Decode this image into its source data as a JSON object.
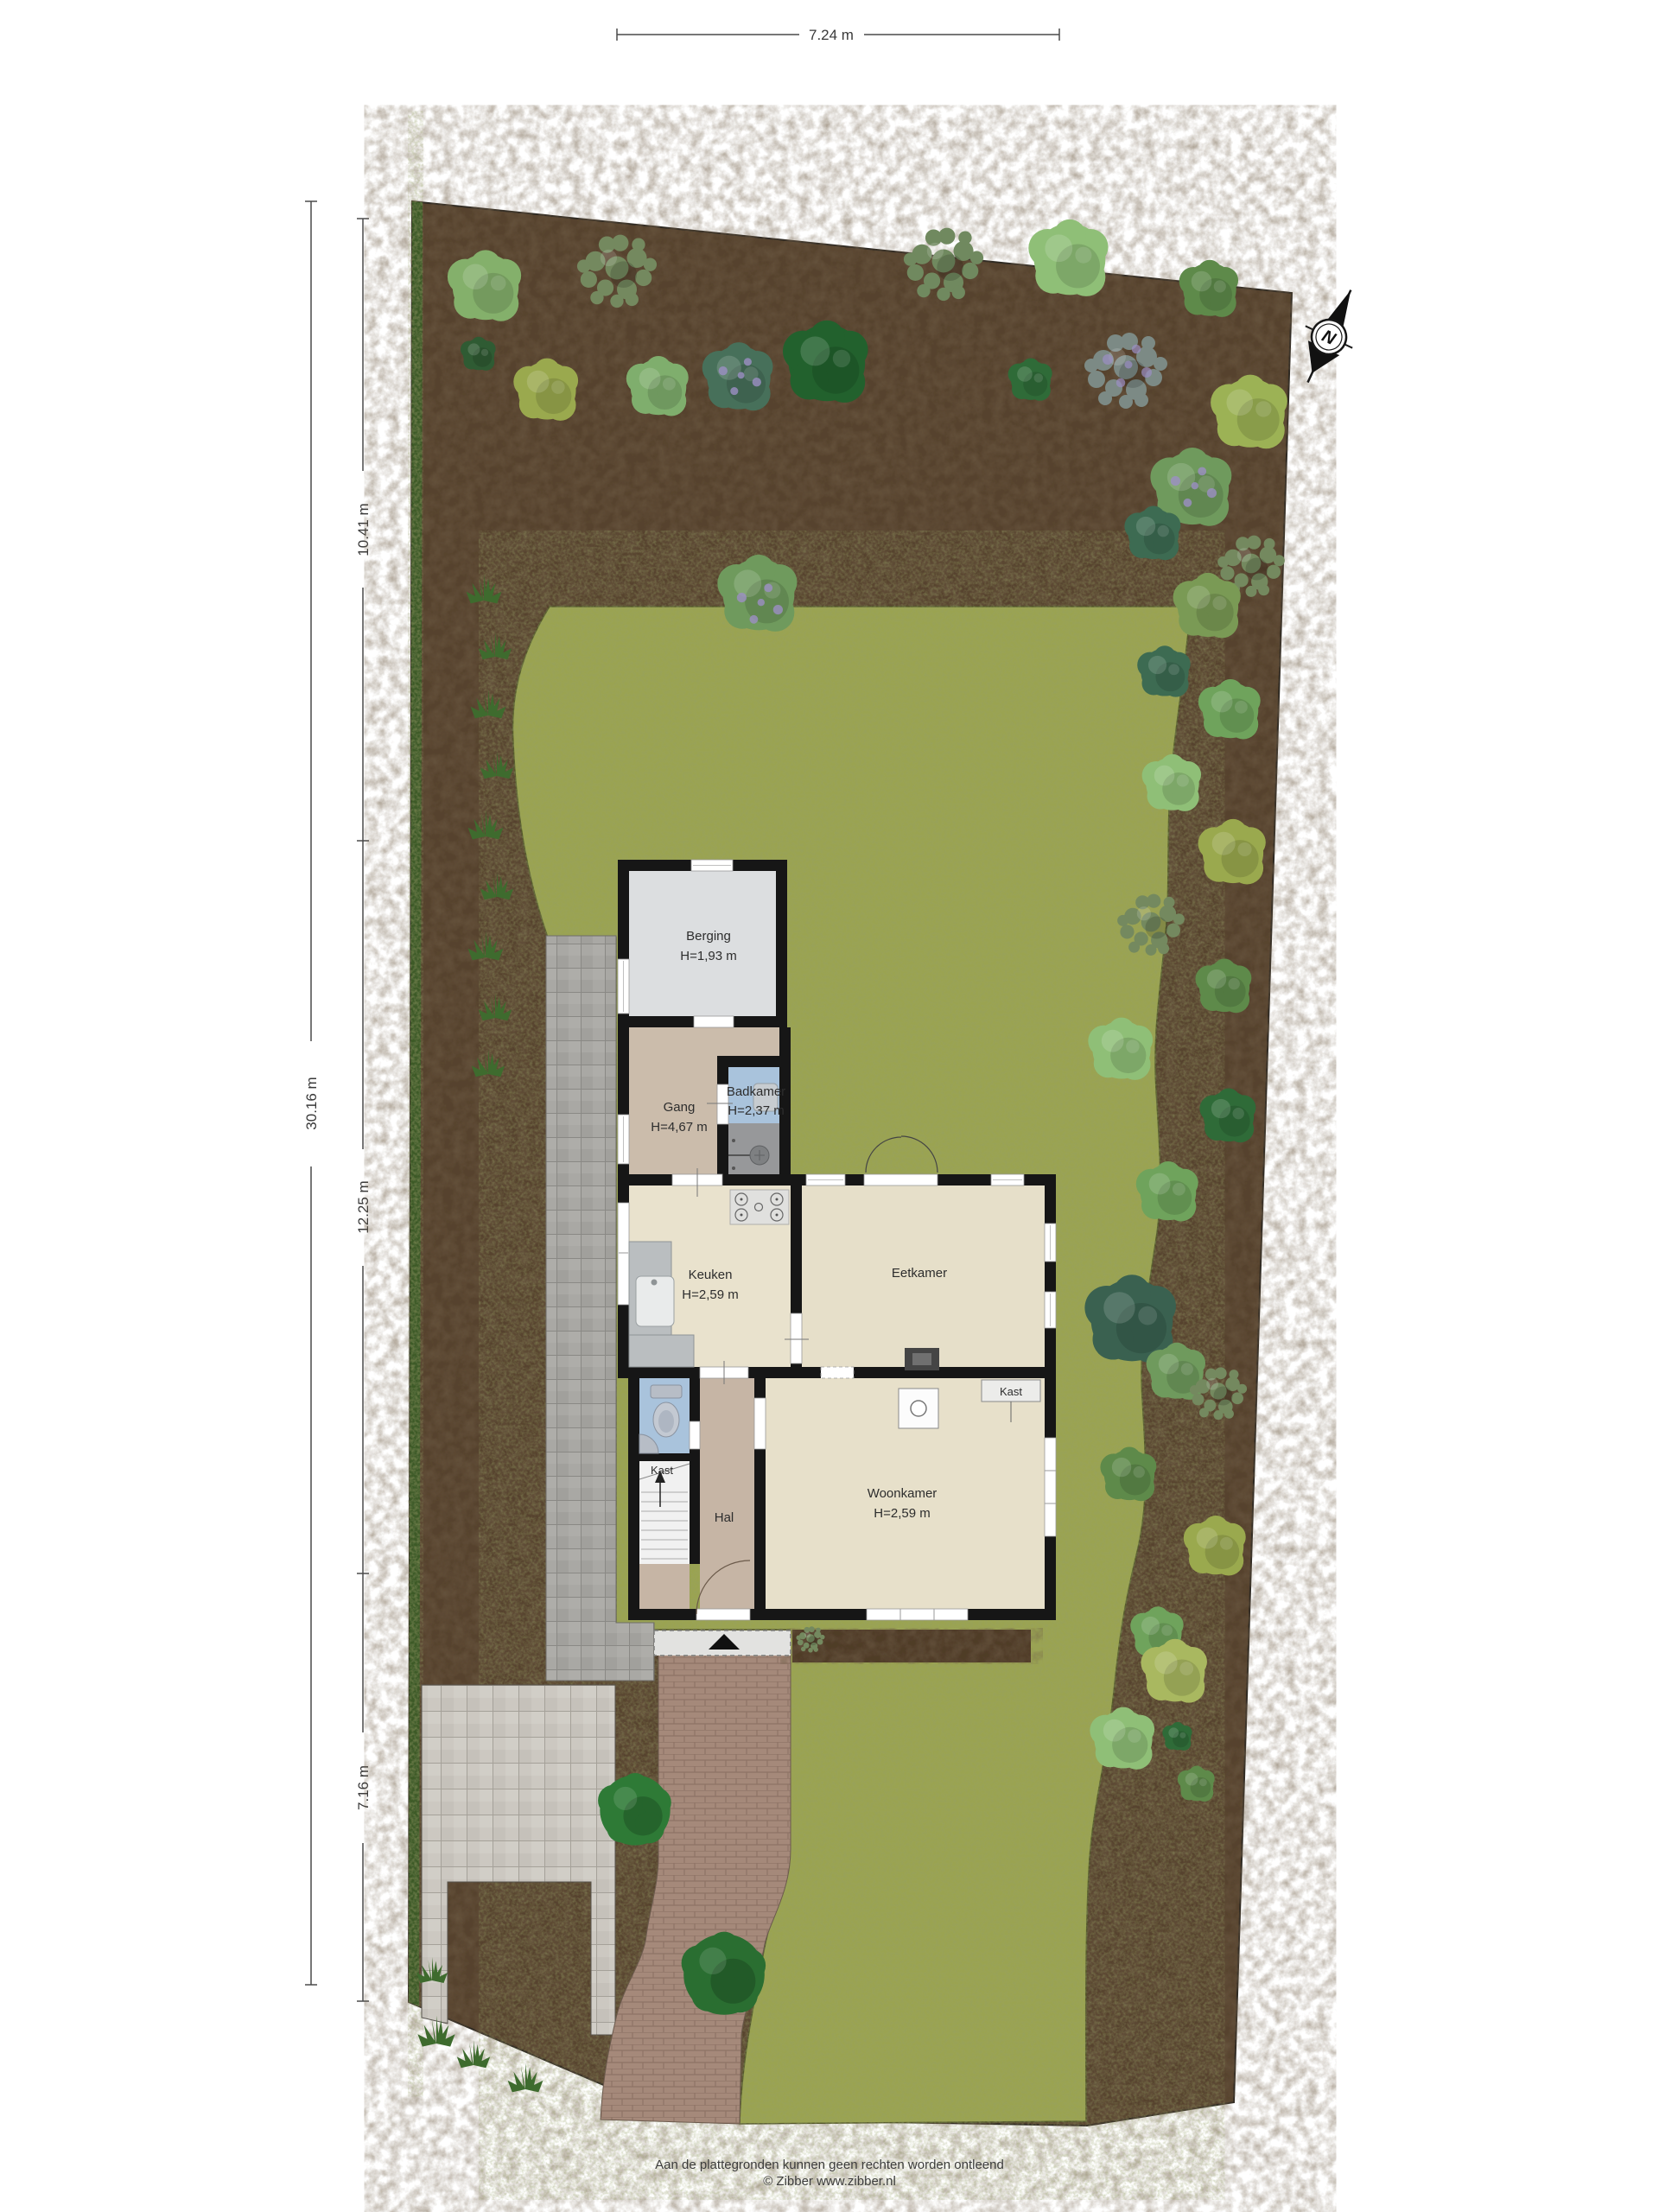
{
  "dimensions": {
    "top": "7.24 m",
    "left_total": "30.16 m",
    "left_seg1": "10.41 m",
    "left_seg2": "12.25 m",
    "left_seg3": "7.16 m"
  },
  "rooms": {
    "berging": {
      "name": "Berging",
      "height": "H=1,93 m"
    },
    "gang": {
      "name": "Gang",
      "height": "H=4,67 m"
    },
    "badkamer": {
      "name": "Badkamer",
      "height": "H=2,37 m"
    },
    "keuken": {
      "name": "Keuken",
      "height": "H=2,59 m"
    },
    "eetkamer": {
      "name": "Eetkamer"
    },
    "woonkamer": {
      "name": "Woonkamer",
      "height": "H=2,59 m"
    },
    "hal": {
      "name": "Hal"
    },
    "kast_hal": {
      "name": "Kast"
    },
    "kast_woonkamer": {
      "name": "Kast"
    }
  },
  "compass": {
    "north": "N"
  },
  "footer": {
    "disclaimer": "Aan de plattegronden kunnen geen rechten worden ontleend",
    "copyright": "© Zibber www.zibber.nl"
  },
  "palette": {
    "soil": "#57432e",
    "lawn": "#9aa351",
    "hedge": "#3c5a28",
    "wall": "#161616",
    "floor_berging": "#dcdee0",
    "floor_gang": "#cbbcab",
    "floor_badkamer": "#a9c3dc",
    "floor_shower": "#97989a",
    "floor_keuken": "#e9e2cd",
    "floor_eetkamer": "#e6dfc9",
    "floor_woonkamer": "#e7e0ca",
    "floor_hal": "#c6b5a5",
    "paver_path": "#a9a8a4",
    "paver_field": "#ccc8c1",
    "brick_path": "#a5897a"
  }
}
